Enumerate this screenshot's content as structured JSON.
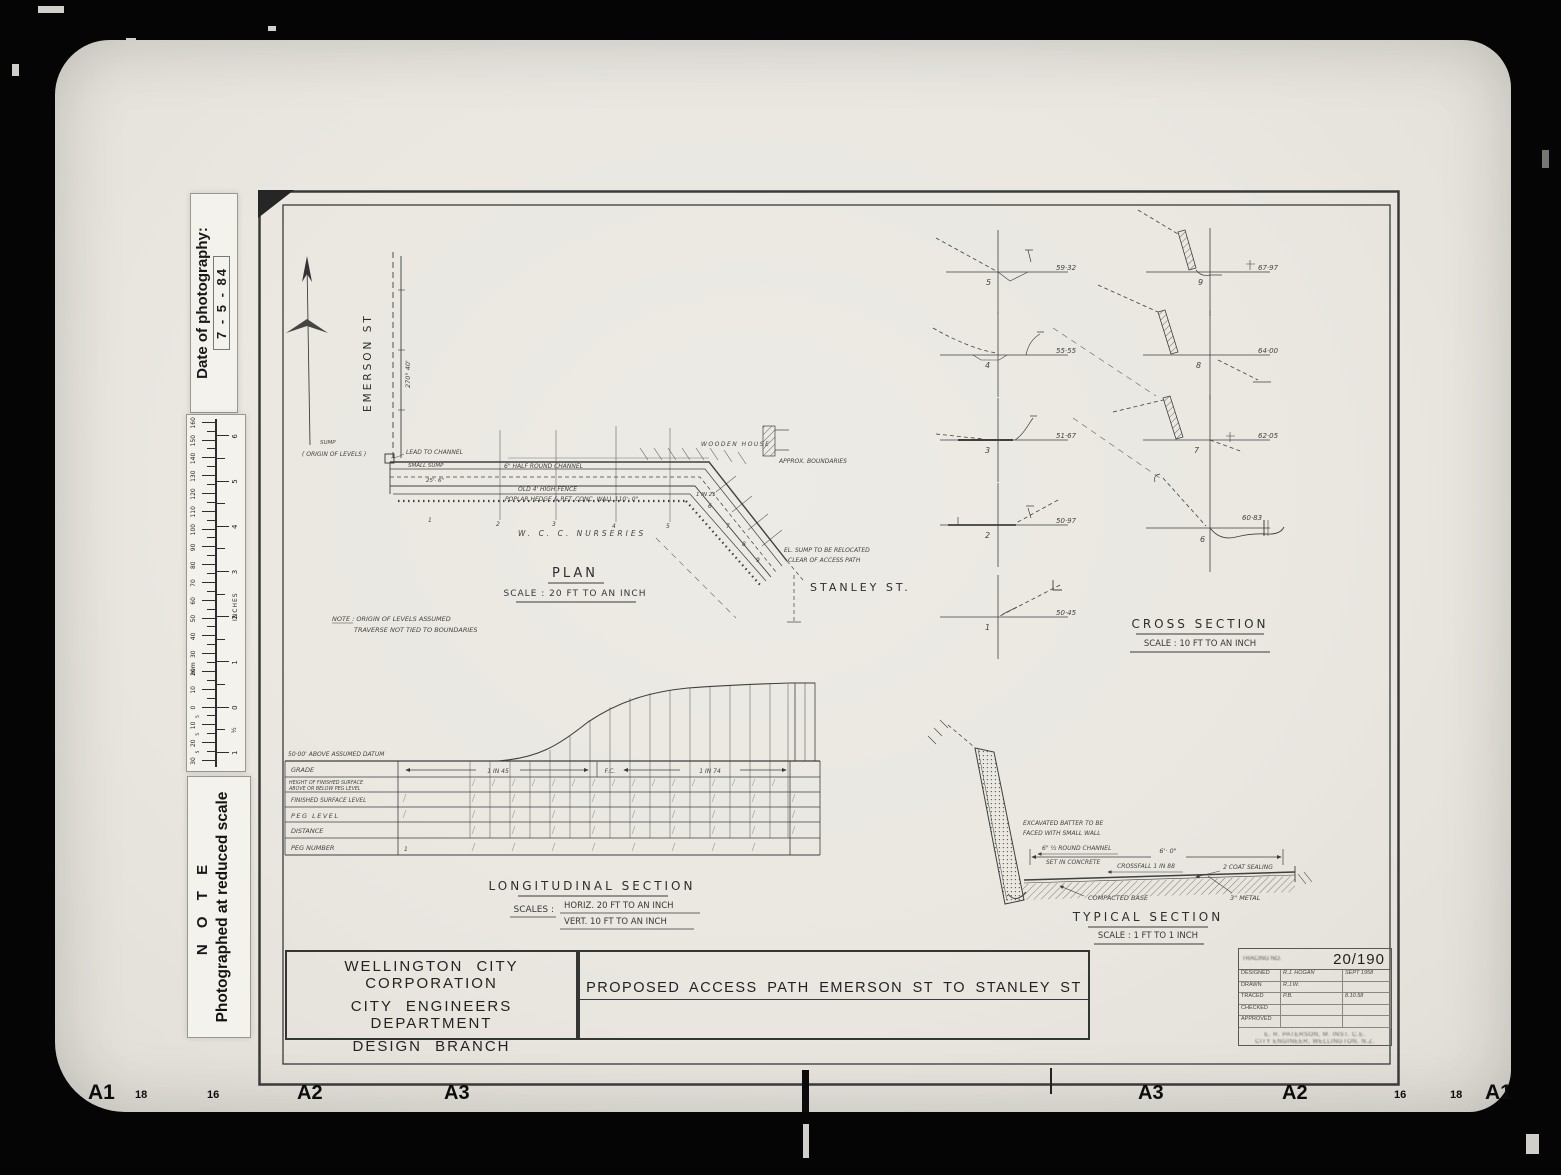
{
  "photo": {
    "date_stamp": {
      "label": "Date of photography:",
      "value": "7 - 5 - 84"
    },
    "note_stamp": {
      "title": "N O T E",
      "text": "Photographed at reduced scale"
    },
    "ruler": {
      "mm_label": "mm",
      "inches_label": "INCHES",
      "mm_min": -30,
      "mm_max": 160,
      "inch_min": -1,
      "inch_max": 6
    },
    "edge_markers_left": [
      "A1",
      "18",
      "16",
      "A2",
      "A3"
    ],
    "edge_markers_right": [
      "A3",
      "A2",
      "16",
      "18",
      "A1"
    ]
  },
  "plan": {
    "title": "PLAN",
    "scale": "SCALE : 20 FT TO AN INCH",
    "street_vertical": "EMERSON ST",
    "street_bottom": "STANLEY ST.",
    "bearing": "270° 40'",
    "nurseries": "W. C. C. NURSERIES",
    "note1": "NOTE : ORIGIN OF LEVELS ASSUMED",
    "note2": "TRAVERSE NOT TIED TO BOUNDARIES",
    "labels": {
      "sump": "SUMP",
      "origin": "( ORIGIN OF LEVELS )",
      "lead_to_channel": "LEAD TO CHANNEL",
      "small_sump": "SMALL SUMP",
      "half_round_channel": "6\" HALF ROUND CHANNEL",
      "dim_25": "25'· 6\"",
      "old_fence": "OLD 4' HIGH FENCE",
      "poplar_hedge": "POPLAR HEDGE & RET. CONC. WALL 110'· 0\"",
      "grade_1in21": "1 IN 21",
      "wooden_house": "WOODEN HOUSE",
      "approx_boundaries": "APPROX. BOUNDARIES",
      "sump_relocated_1": "EL. SUMP TO BE RELOCATED",
      "sump_relocated_2": "CLEAR OF ACCESS PATH"
    },
    "section_markers": [
      "1",
      "2",
      "3",
      "4",
      "5",
      "6",
      "7",
      "8",
      "9"
    ]
  },
  "cross_section": {
    "title": "CROSS SECTION",
    "scale": "SCALE : 10 FT TO AN INCH",
    "left": [
      {
        "no": "5",
        "level": "59·32"
      },
      {
        "no": "4",
        "level": "55·55"
      },
      {
        "no": "3",
        "level": "51·67"
      },
      {
        "no": "2",
        "level": "50·97"
      },
      {
        "no": "1",
        "level": "50·45"
      }
    ],
    "right": [
      {
        "no": "9",
        "level": "67·97"
      },
      {
        "no": "8",
        "level": "64·00"
      },
      {
        "no": "7",
        "level": "62·05"
      },
      {
        "no": "6",
        "level": "60·83"
      }
    ]
  },
  "longitudinal": {
    "title": "LONGITUDINAL SECTION",
    "scales_label": "SCALES :",
    "scale_horiz": "HORIZ. 20 FT TO AN INCH",
    "scale_vert": "VERT. 10 FT TO AN INCH",
    "datum": "50·00' ABOVE ASSUMED DATUM",
    "row_grade": "GRADE",
    "row_height1": "HEIGHT OF FINISHED SURFACE",
    "row_height2": "ABOVE OR BELOW PEG LEVEL",
    "row_fsl": "FINISHED SURFACE LEVEL",
    "row_peg": "PEG LEVEL",
    "row_dist": "DISTANCE",
    "row_pegno": "PEG NUMBER",
    "grade1": "1 IN 45",
    "fc": "F.C.",
    "grade2": "1 IN 74",
    "first_peg": "1"
  },
  "typical": {
    "title": "TYPICAL SECTION",
    "scale": "SCALE : 1 FT TO 1 INCH",
    "labels": {
      "batter1": "EXCAVATED BATTER TO BE",
      "batter2": "FACED WITH SMALL WALL",
      "channel1": "6\" ½ ROUND CHANNEL",
      "channel2": "SET IN CONCRETE",
      "dim": "6'· 0\"",
      "crossfall": "CROSSFALL 1 IN 88",
      "sealing": "2 COAT SEALING",
      "base": "COMPACTED BASE",
      "metal": "3\" METAL"
    }
  },
  "title_block": {
    "org1": "WELLINGTON CITY CORPORATION",
    "org2": "CITY ENGINEERS DEPARTMENT",
    "org3": "DESIGN BRANCH",
    "drawing_title": "PROPOSED ACCESS PATH EMERSON ST TO STANLEY ST",
    "tracing_label": "TRACING NO.",
    "tracing_no": "20/190",
    "rows": [
      {
        "label": "DESIGNED",
        "value": "R.J. HOGAN",
        "date": "SEPT 1958"
      },
      {
        "label": "DRAWN",
        "value": "R.J.W.",
        "date": ""
      },
      {
        "label": "TRACED",
        "value": "P.B.",
        "date": "8.10.58"
      },
      {
        "label": "CHECKED",
        "value": "",
        "date": ""
      },
      {
        "label": "APPROVED",
        "value": "",
        "date": ""
      }
    ],
    "footer1": "E. R. PATERSON, M. INST. C.E.",
    "footer2": "CITY ENGINEER, WELLINGTON, N.Z."
  },
  "colors": {
    "paper": "#e9e7e0",
    "ink": "#383838",
    "black_frame": "#050505"
  }
}
